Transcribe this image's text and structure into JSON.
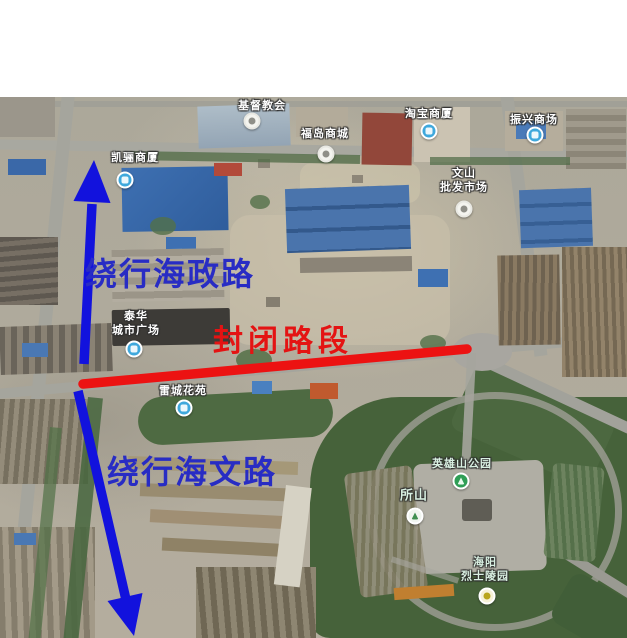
{
  "map": {
    "kind": "satellite-road-closure-notice",
    "labels": [
      {
        "text": "基督教会",
        "icon": "church-poi-icon"
      },
      {
        "text": "凯骊商厦",
        "icon": "mall-poi-icon"
      },
      {
        "text": "福岛商城",
        "icon": "shop-poi-icon"
      },
      {
        "text": "淘宝商厦",
        "icon": "mall-poi-icon"
      },
      {
        "text": "振兴商场",
        "icon": "mall-poi-icon"
      },
      {
        "text": "文山\n批发市场",
        "icon": "market-poi-icon"
      },
      {
        "text": "泰华\n城市广场",
        "icon": "mall-poi-icon"
      },
      {
        "text": "雷城花苑",
        "icon": "residence-poi-icon"
      },
      {
        "text": "英雄山公园",
        "icon": "park-poi-icon"
      },
      {
        "text": "所山",
        "icon": "mountain-poi-icon"
      },
      {
        "text": "海阳\n烈士陵园",
        "icon": "memorial-poi-icon"
      }
    ],
    "annotations": {
      "detour_north": {
        "text": "绕行海政路",
        "color": "#282cc4"
      },
      "closed_segment": {
        "text": "封闭路段",
        "color": "#e41313"
      },
      "detour_south": {
        "text": "绕行海文路",
        "color": "#282cc4"
      }
    },
    "overlay_colors": {
      "detour_arrow_blue": "#1212dd",
      "closed_road_red": "#ec1212"
    }
  }
}
